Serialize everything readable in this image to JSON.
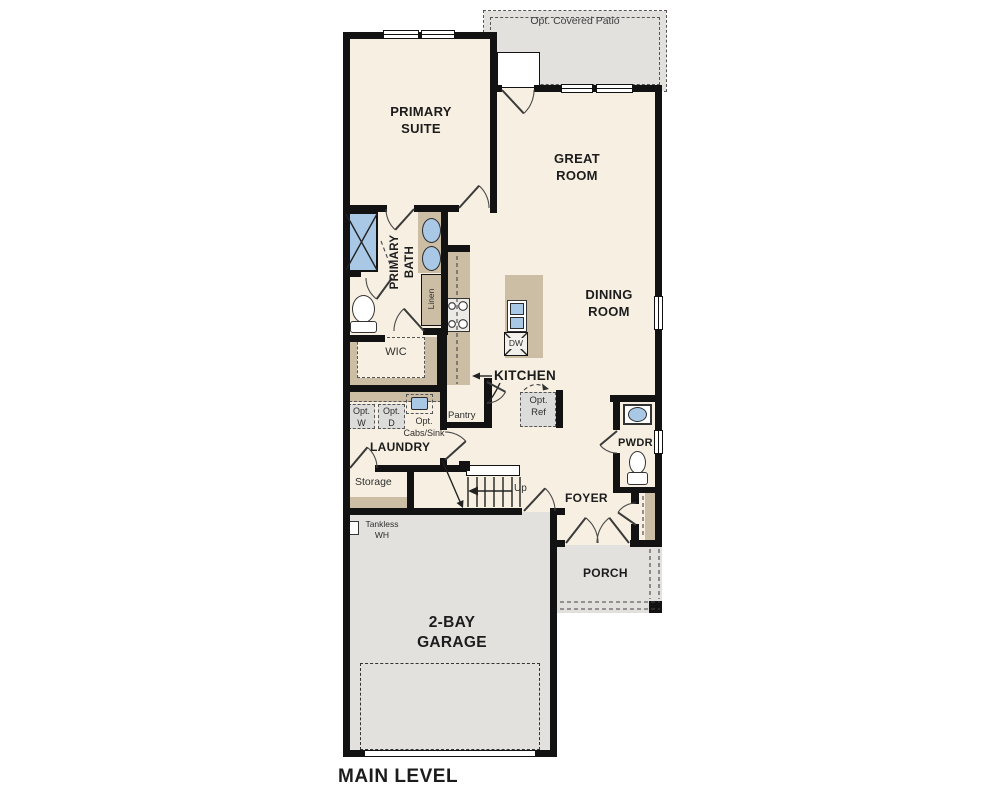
{
  "title": "MAIN LEVEL",
  "colors": {
    "wall": "#121212",
    "floor": "#f7f0e2",
    "counter": "#ccbea4",
    "concrete": "#e2e1de",
    "optional": "#dcdcda",
    "fixture": "#a9c8e6",
    "line": "#4a4a4a",
    "text": "#1c1c1c"
  },
  "rooms": {
    "patio": {
      "label": "Opt. Covered Patio"
    },
    "primary_suite": {
      "label": "PRIMARY SUITE"
    },
    "great_room": {
      "label": "GREAT ROOM"
    },
    "primary_bath": {
      "label": "PRIMARY BATH"
    },
    "wic": {
      "label": "WIC"
    },
    "dining_room": {
      "label": "DINING ROOM"
    },
    "kitchen": {
      "label": "KITCHEN"
    },
    "laundry": {
      "label": "LAUNDRY"
    },
    "storage": {
      "label": "Storage"
    },
    "pwdr": {
      "label": "PWDR"
    },
    "foyer": {
      "label": "FOYER"
    },
    "porch": {
      "label": "PORCH"
    },
    "garage": {
      "label": "2-BAY GARAGE"
    }
  },
  "features": {
    "linen": "Linen",
    "pantry": "Pantry",
    "opt_ref": "Opt. Ref",
    "opt_washer": "Opt. W",
    "opt_dryer": "Opt. D",
    "opt_cabs_sink": "Opt. Cabs/Sink",
    "dishwasher": "DW",
    "stairs_up": "Up",
    "tankless_water_heater": "Tankless WH"
  }
}
